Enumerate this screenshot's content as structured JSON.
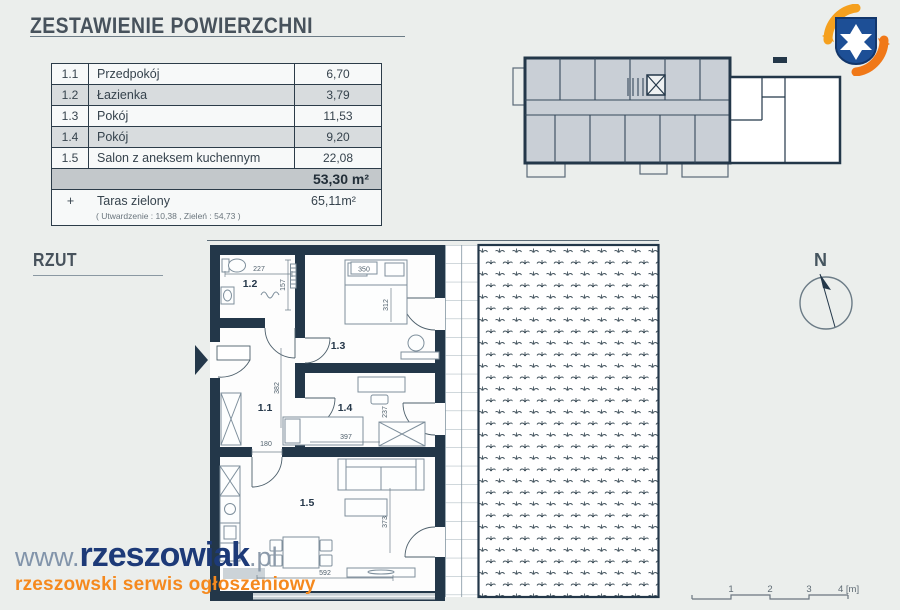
{
  "header": {
    "title": "ZESTAWIENIE POWIERZCHNI"
  },
  "area_table": {
    "rows": [
      {
        "no": "1.1",
        "name": "Przedpokój",
        "area": "6,70"
      },
      {
        "no": "1.2",
        "name": "Łazienka",
        "area": "3,79"
      },
      {
        "no": "1.3",
        "name": "Pokój",
        "area": "11,53"
      },
      {
        "no": "1.4",
        "name": "Pokój",
        "area": "9,20"
      },
      {
        "no": "1.5",
        "name": "Salon z aneksem kuchennym",
        "area": "22,08"
      }
    ],
    "total": "53,30 m²",
    "extra": {
      "sign": "+",
      "name": "Taras zielony",
      "area": "65,11m²",
      "note": "( Utwardzenie : 10,38 ,  Zieleń : 54,73 )"
    }
  },
  "plan": {
    "heading": "RZUT",
    "labels": {
      "r11": "1.1",
      "r12": "1.2",
      "r13": "1.3",
      "r14": "1.4",
      "r15": "1.5"
    },
    "dims": {
      "d227": "227",
      "d157": "157",
      "d350": "350",
      "d312": "312",
      "d382": "382",
      "d180": "180",
      "d397": "397",
      "d237": "237",
      "d373": "373",
      "d592": "592"
    }
  },
  "compass": {
    "label": "N"
  },
  "scale": {
    "t1": "1",
    "t2": "2",
    "t3": "3",
    "t4": "4 [m]"
  },
  "branding": {
    "prefix": "www.",
    "name": "rzeszowiak",
    "suffix": ".pl",
    "tagline": "rzeszowski serwis ogłoszeniowy"
  },
  "colors": {
    "wall": "#233749",
    "accent_orange": "#f5891e",
    "brand_navy": "#1d3a78",
    "row_alt": "#d8dcde",
    "row_total": "#c3c8cb",
    "background": "#ebeeec"
  }
}
